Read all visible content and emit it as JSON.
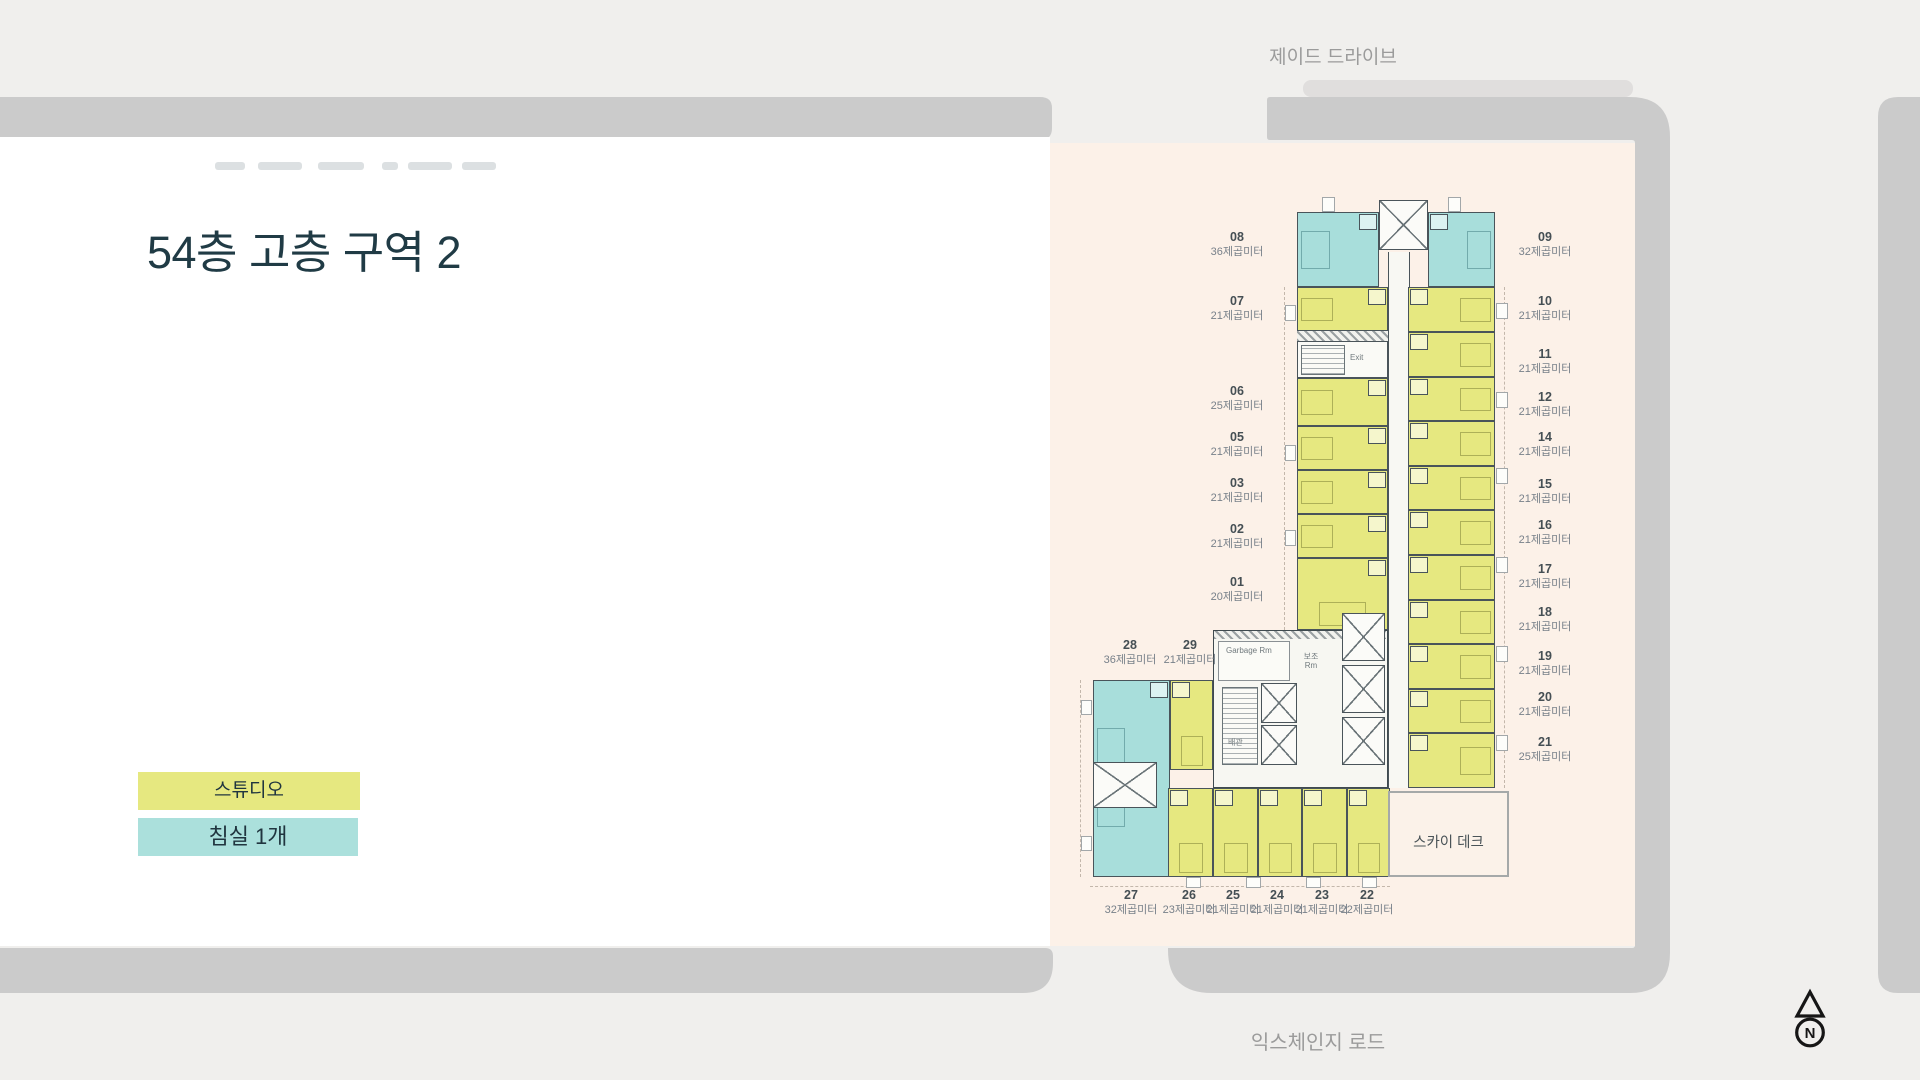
{
  "title": "54층 고층 구역 2",
  "roads": {
    "top": "제이드 드라이브",
    "bottom": "익스체인지 로드"
  },
  "legend": [
    {
      "label": "스튜디오"
    },
    {
      "label": "침실 1개"
    }
  ],
  "compass": {
    "n": "N"
  },
  "plan": {
    "sky_deck": "스카이 데크",
    "exit": "Exit",
    "garbage": "Garbage Rm",
    "aux": "보조\nRm",
    "pipe": "배관",
    "left": [
      {
        "no": "08",
        "area": "36제곱미터"
      },
      {
        "no": "07",
        "area": "21제곱미터"
      },
      {
        "no": "06",
        "area": "25제곱미터"
      },
      {
        "no": "05",
        "area": "21제곱미터"
      },
      {
        "no": "03",
        "area": "21제곱미터"
      },
      {
        "no": "02",
        "area": "21제곱미터"
      },
      {
        "no": "01",
        "area": "20제곱미터"
      }
    ],
    "right": [
      {
        "no": "09",
        "area": "32제곱미터"
      },
      {
        "no": "10",
        "area": "21제곱미터"
      },
      {
        "no": "11",
        "area": "21제곱미터"
      },
      {
        "no": "12",
        "area": "21제곱미터"
      },
      {
        "no": "14",
        "area": "21제곱미터"
      },
      {
        "no": "15",
        "area": "21제곱미터"
      },
      {
        "no": "16",
        "area": "21제곱미터"
      },
      {
        "no": "17",
        "area": "21제곱미터"
      },
      {
        "no": "18",
        "area": "21제곱미터"
      },
      {
        "no": "19",
        "area": "21제곱미터"
      },
      {
        "no": "20",
        "area": "21제곱미터"
      },
      {
        "no": "21",
        "area": "25제곱미터"
      }
    ],
    "wing": [
      {
        "no": "28",
        "area": "36제곱미터"
      },
      {
        "no": "29",
        "area": "21제곱미터"
      }
    ],
    "bottom": [
      {
        "no": "27",
        "area": "32제곱미터"
      },
      {
        "no": "26",
        "area": "23제곱미터"
      },
      {
        "no": "25",
        "area": "21제곱미터"
      },
      {
        "no": "24",
        "area": "21제곱미터"
      },
      {
        "no": "23",
        "area": "21제곱미터"
      },
      {
        "no": "22",
        "area": "22제곱미터"
      }
    ]
  },
  "colors": {
    "studio": "#e6e880",
    "one_bedroom": "#a8dedb",
    "plot": "#fcf1e8",
    "road": "#cbcbcb",
    "title_text": "#203b45",
    "road_label_text": "#9b9b9b"
  }
}
